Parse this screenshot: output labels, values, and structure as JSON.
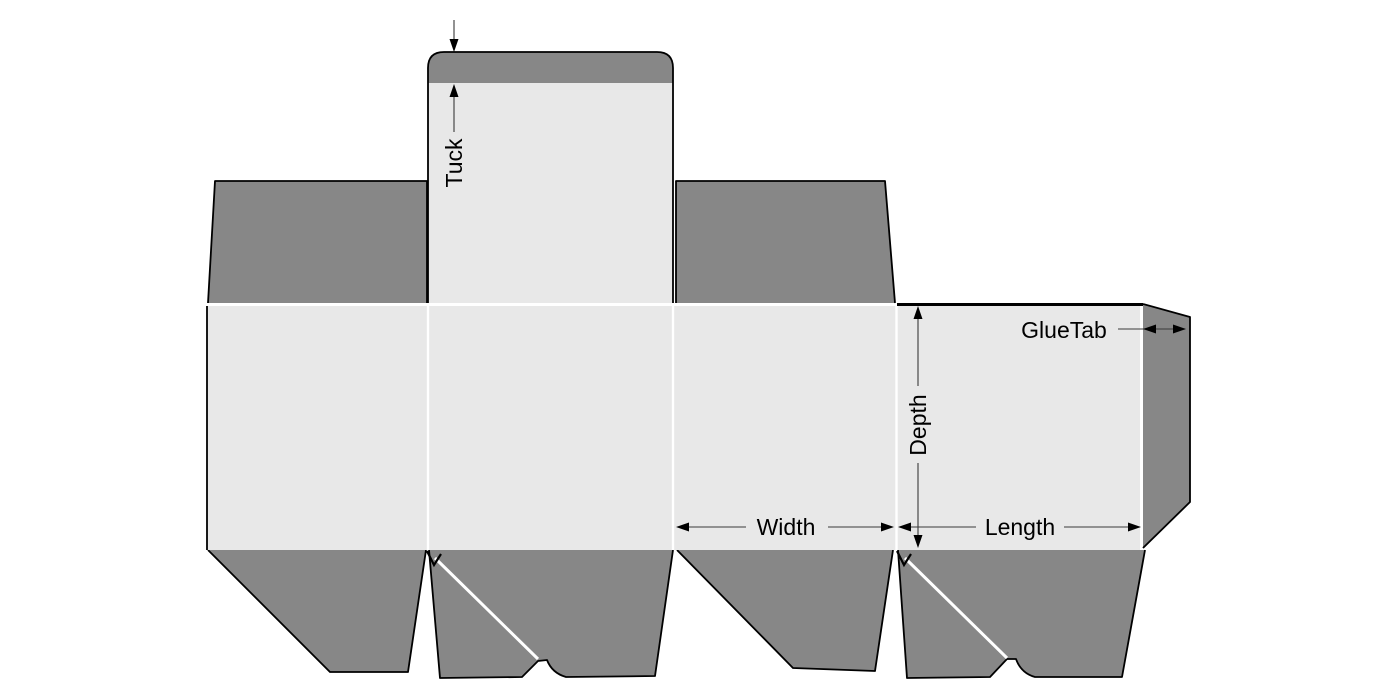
{
  "diagram": {
    "kind": "tuck-box-dieline",
    "labels": {
      "tuck": "Tuck",
      "depth": "Depth",
      "width": "Width",
      "length": "Length",
      "glue_tab": "GlueTab"
    },
    "colors": {
      "flap_fill": "#878787",
      "panel_fill": "#e8e8e8",
      "cut_line": "#000000",
      "crease_line": "#ffffff",
      "dimension_line": "#3a3a3a",
      "text": "#000000",
      "background": "#ffffff"
    }
  }
}
